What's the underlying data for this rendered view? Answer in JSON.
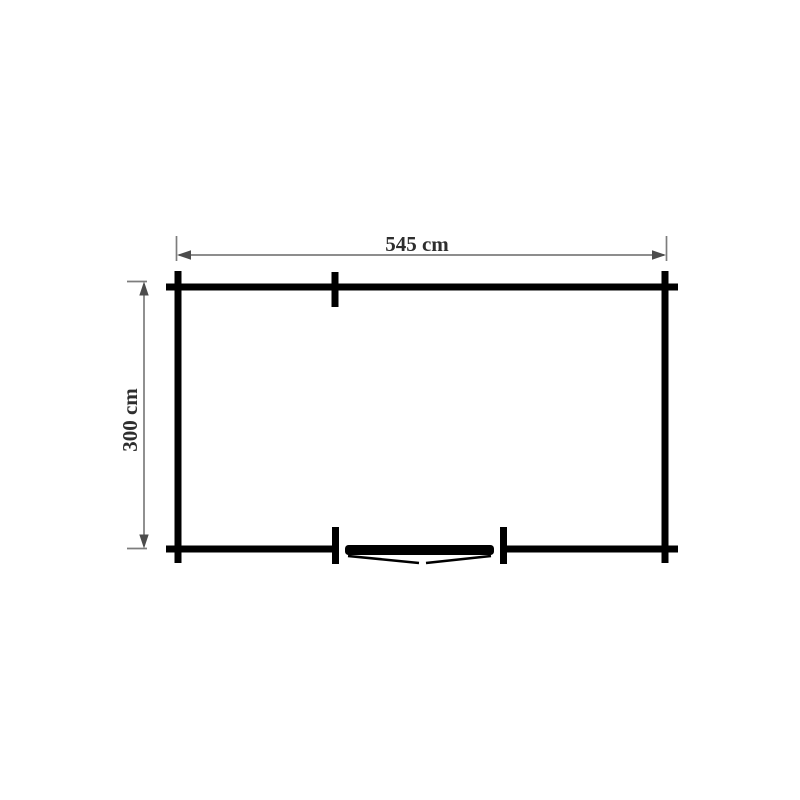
{
  "diagram": {
    "type": "floor-plan",
    "width_dimension": {
      "label": "545 cm",
      "value_cm": 545
    },
    "height_dimension": {
      "label": "300 cm",
      "value_cm": 300
    },
    "door": {
      "type": "double",
      "position": "bottom-center"
    },
    "colors": {
      "background": "#ffffff",
      "wall": "#000000",
      "dim-line": "#7d7d7d",
      "dim-arrow": "#4c4c4c",
      "dim-text": "#2e2e2e"
    }
  }
}
